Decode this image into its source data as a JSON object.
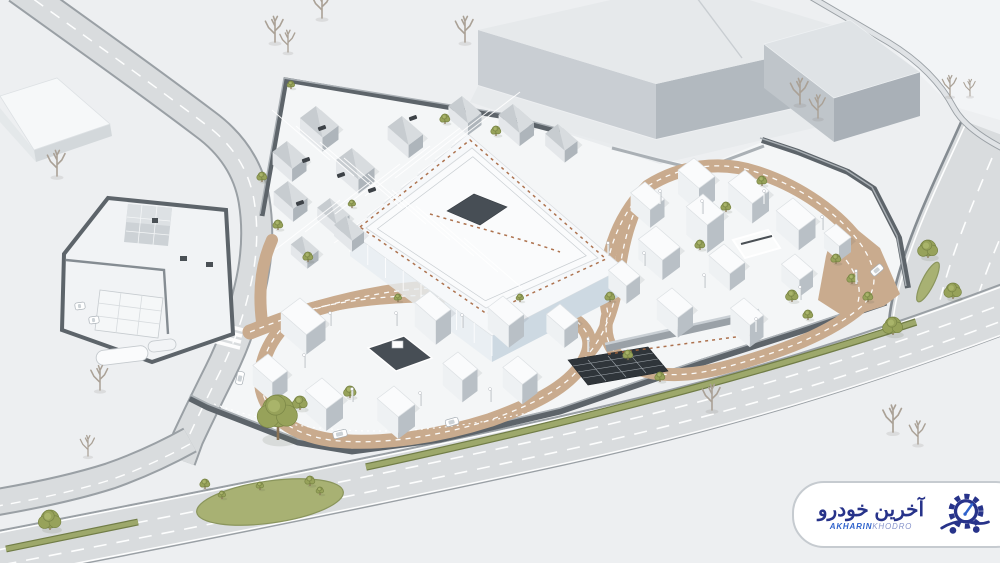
{
  "watermark": {
    "title_fa": "آخرین خودرو",
    "title_en_bold": "AKHARIN",
    "title_en_light": "KHODRO"
  },
  "palette": {
    "bg": "#edeff1",
    "pale_land": "#f2f4f6",
    "campus_ground": "#f4f6f7",
    "road_fill": "#d9dcde",
    "road_edge": "#9aa0a5",
    "road_line": "#ffffff",
    "median_green": "#9da86b",
    "median_dark": "#717d47",
    "grass": "#a8b173",
    "grass_dark": "#8a955c",
    "tan": "#c9ab8e",
    "wall_dark": "#5d646a",
    "wall_mid": "#858c92",
    "wall_light": "#aab0b5",
    "cube_roof": "#fafbfc",
    "cube_left": "#eef1f3",
    "cube_right": "#b9c0c6",
    "cube_edge": "#dde1e4",
    "shed_roof_a": "#d8dcdf",
    "shed_roof_b": "#c7ccd0",
    "shed_left": "#e4e7ea",
    "shed_right": "#aeb5bb",
    "factory_roof": "#e6e9eb",
    "factory_left": "#c9ced3",
    "factory_right": "#b2b9bf",
    "glass_a": "#cdd9e2",
    "glass_b": "#e7edf1",
    "solar": "#2f353a",
    "pit": "#474e55",
    "orange": "#a5643c",
    "tree_green": "#97a25a",
    "tree_green_dark": "#7a8646",
    "tree_highlight": "#a9b46a",
    "trunk": "#8a7355",
    "tree_bare": "#aaa196",
    "shadow": "rgba(70,80,92,0.10)",
    "logo_navy": "#27338a",
    "logo_blue": "#2e62cc",
    "logo_light": "#8895cc",
    "badge_border": "#c6cbd0"
  },
  "scene": {
    "buildings_shed": [
      [
        462,
        96,
        26,
        17,
        12
      ],
      [
        513,
        104,
        28,
        18,
        13
      ],
      [
        558,
        124,
        26,
        16,
        12
      ],
      [
        402,
        116,
        28,
        18,
        13
      ],
      [
        316,
        106,
        30,
        20,
        14
      ],
      [
        352,
        148,
        30,
        20,
        14
      ],
      [
        287,
        141,
        26,
        18,
        13
      ],
      [
        288,
        181,
        26,
        18,
        13
      ],
      [
        330,
        198,
        26,
        16,
        12
      ],
      [
        346,
        216,
        24,
        15,
        11
      ],
      [
        302,
        236,
        22,
        14,
        10
      ]
    ],
    "buildings_white": [
      [
        694,
        158,
        28,
        20,
        24
      ],
      [
        745,
        170,
        32,
        21,
        20
      ],
      [
        645,
        182,
        26,
        18,
        18
      ],
      [
        703,
        194,
        28,
        21,
        28
      ],
      [
        793,
        198,
        30,
        21,
        20
      ],
      [
        836,
        224,
        20,
        15,
        15
      ],
      [
        656,
        226,
        32,
        22,
        20
      ],
      [
        724,
        244,
        28,
        19,
        17
      ],
      [
        795,
        254,
        24,
        17,
        17
      ],
      [
        622,
        260,
        24,
        17,
        18
      ],
      [
        672,
        288,
        28,
        19,
        20
      ],
      [
        744,
        298,
        26,
        17,
        22
      ],
      [
        300,
        298,
        34,
        24,
        20
      ],
      [
        430,
        291,
        28,
        19,
        24
      ],
      [
        503,
        296,
        28,
        19,
        22
      ],
      [
        560,
        304,
        24,
        17,
        18
      ],
      [
        268,
        354,
        26,
        19,
        20
      ],
      [
        458,
        352,
        26,
        19,
        22
      ],
      [
        518,
        356,
        26,
        19,
        20
      ],
      [
        322,
        378,
        28,
        21,
        22
      ],
      [
        394,
        386,
        28,
        21,
        22
      ]
    ],
    "trees_green": [
      [
        291,
        87,
        3
      ],
      [
        262,
        180,
        4
      ],
      [
        278,
        228,
        4
      ],
      [
        308,
        260,
        4
      ],
      [
        445,
        122,
        4
      ],
      [
        496,
        134,
        4
      ],
      [
        352,
        206,
        3
      ],
      [
        300,
        408,
        6
      ],
      [
        350,
        396,
        5
      ],
      [
        398,
        300,
        3
      ],
      [
        520,
        300,
        3
      ],
      [
        610,
        300,
        4
      ],
      [
        628,
        358,
        4
      ],
      [
        660,
        380,
        4
      ],
      [
        700,
        248,
        4
      ],
      [
        726,
        210,
        4
      ],
      [
        762,
        184,
        4
      ],
      [
        792,
        300,
        5
      ],
      [
        808,
        318,
        4
      ],
      [
        836,
        262,
        4
      ],
      [
        852,
        282,
        4
      ],
      [
        868,
        300,
        4
      ],
      [
        893,
        333,
        8
      ],
      [
        928,
        256,
        8
      ],
      [
        953,
        297,
        7
      ],
      [
        50,
        528,
        9
      ],
      [
        205,
        487,
        4
      ],
      [
        222,
        497,
        3
      ],
      [
        260,
        488,
        3
      ],
      [
        310,
        484,
        4
      ],
      [
        320,
        493,
        3
      ]
    ],
    "big_tree": [
      278,
      438,
      16
    ],
    "trees_bare": [
      [
        322,
        18,
        1
      ],
      [
        275,
        42,
        1
      ],
      [
        288,
        52,
        0.85
      ],
      [
        465,
        42,
        1
      ],
      [
        57,
        176,
        1
      ],
      [
        100,
        390,
        0.95
      ],
      [
        88,
        456,
        0.8
      ],
      [
        712,
        410,
        1
      ],
      [
        893,
        432,
        1.05
      ],
      [
        918,
        444,
        0.9
      ],
      [
        800,
        104,
        1
      ],
      [
        818,
        118,
        0.9
      ],
      [
        950,
        96,
        0.8
      ],
      [
        970,
        96,
        0.65
      ]
    ],
    "cars_white": [
      [
        240,
        378,
        -78,
        13
      ],
      [
        340,
        434,
        -14,
        14
      ],
      [
        452,
        422,
        -16,
        13
      ],
      [
        877,
        270,
        -40,
        13
      ],
      [
        80,
        306,
        -8,
        10
      ],
      [
        94,
        320,
        -8,
        10
      ]
    ],
    "cars_dark": [
      [
        322,
        128,
        -20
      ],
      [
        306,
        160,
        -20
      ],
      [
        341,
        175,
        -20
      ],
      [
        372,
        190,
        -20
      ],
      [
        300,
        203,
        -20
      ],
      [
        413,
        118,
        -20
      ]
    ],
    "light_poles": [
      [
        660,
        204
      ],
      [
        702,
        214
      ],
      [
        764,
        204
      ],
      [
        822,
        230
      ],
      [
        644,
        266
      ],
      [
        704,
        288
      ],
      [
        756,
        332
      ],
      [
        800,
        300
      ],
      [
        856,
        284
      ],
      [
        330,
        326
      ],
      [
        396,
        326
      ],
      [
        462,
        328
      ],
      [
        352,
        402
      ],
      [
        420,
        406
      ],
      [
        490,
        402
      ],
      [
        304,
        368
      ],
      [
        608,
        256
      ],
      [
        588,
        352
      ]
    ]
  }
}
